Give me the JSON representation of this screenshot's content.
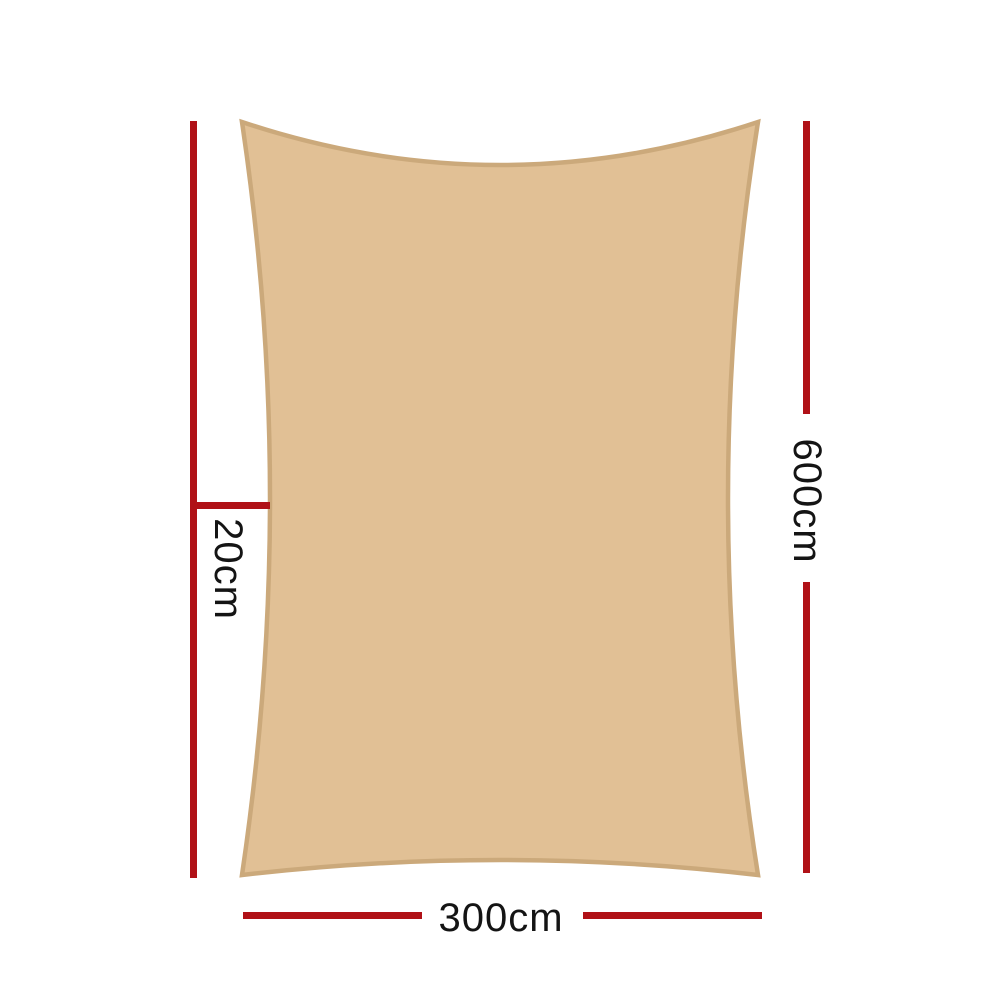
{
  "colors": {
    "background": "#ffffff",
    "accent": "#b01117",
    "text": "#141414",
    "sail_fill": "#e1c095",
    "sail_border": "#cba97b"
  },
  "labels": {
    "height": "600cm",
    "width": "300cm",
    "offset": "20cm"
  }
}
